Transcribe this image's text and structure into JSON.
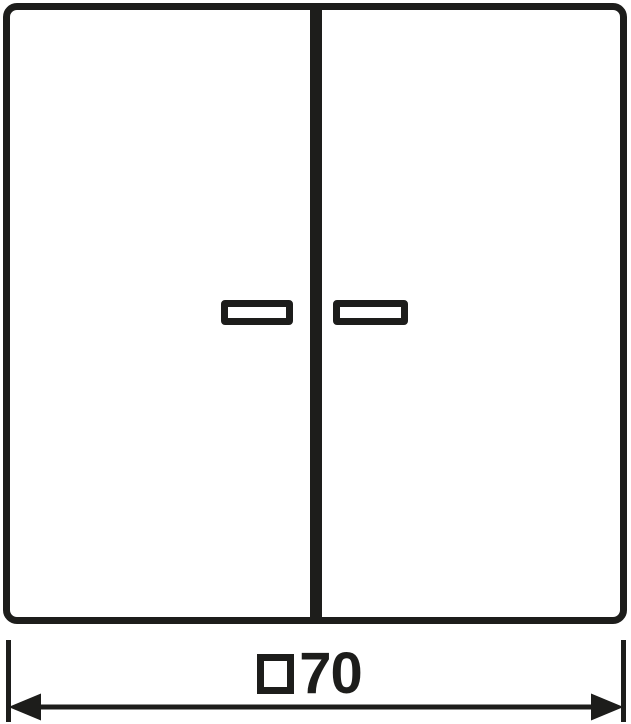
{
  "colors": {
    "line": "#1d1d1b",
    "background": "#ffffff"
  },
  "dimension": {
    "symbol_glyph": "□",
    "value": "70"
  }
}
